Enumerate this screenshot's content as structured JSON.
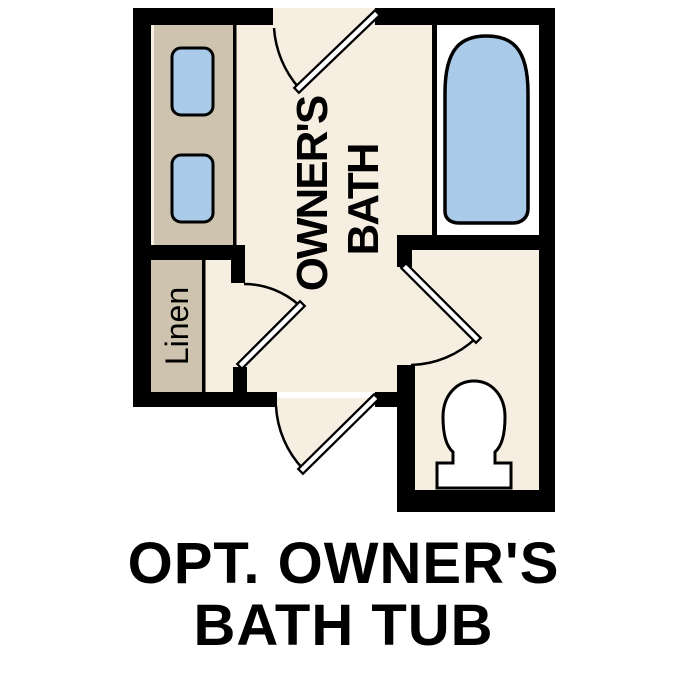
{
  "caption": {
    "line1": "OPT. OWNER'S",
    "line2": "BATH TUB"
  },
  "plan": {
    "room_label_line1": "OWNER'S",
    "room_label_line2": "BATH",
    "linen_label": "Linen"
  },
  "colors": {
    "background": "#ffffff",
    "wall": "#000000",
    "floor": "#f5eee1",
    "cabinetry": "#cdc3ae",
    "fixture_blue": "#a9cbe9",
    "fixture_white": "#ffffff",
    "outline": "#000000",
    "text": "#000000"
  },
  "icons": {
    "tub": "bathtub-top-view-icon",
    "toilet": "toilet-top-view-icon",
    "sink_top": "sink-basin-icon",
    "sink_bottom": "sink-basin-icon",
    "door_top": "door-swing-icon",
    "door_linen": "door-swing-icon",
    "door_water_closet": "door-swing-icon",
    "door_bottom": "door-swing-icon"
  }
}
